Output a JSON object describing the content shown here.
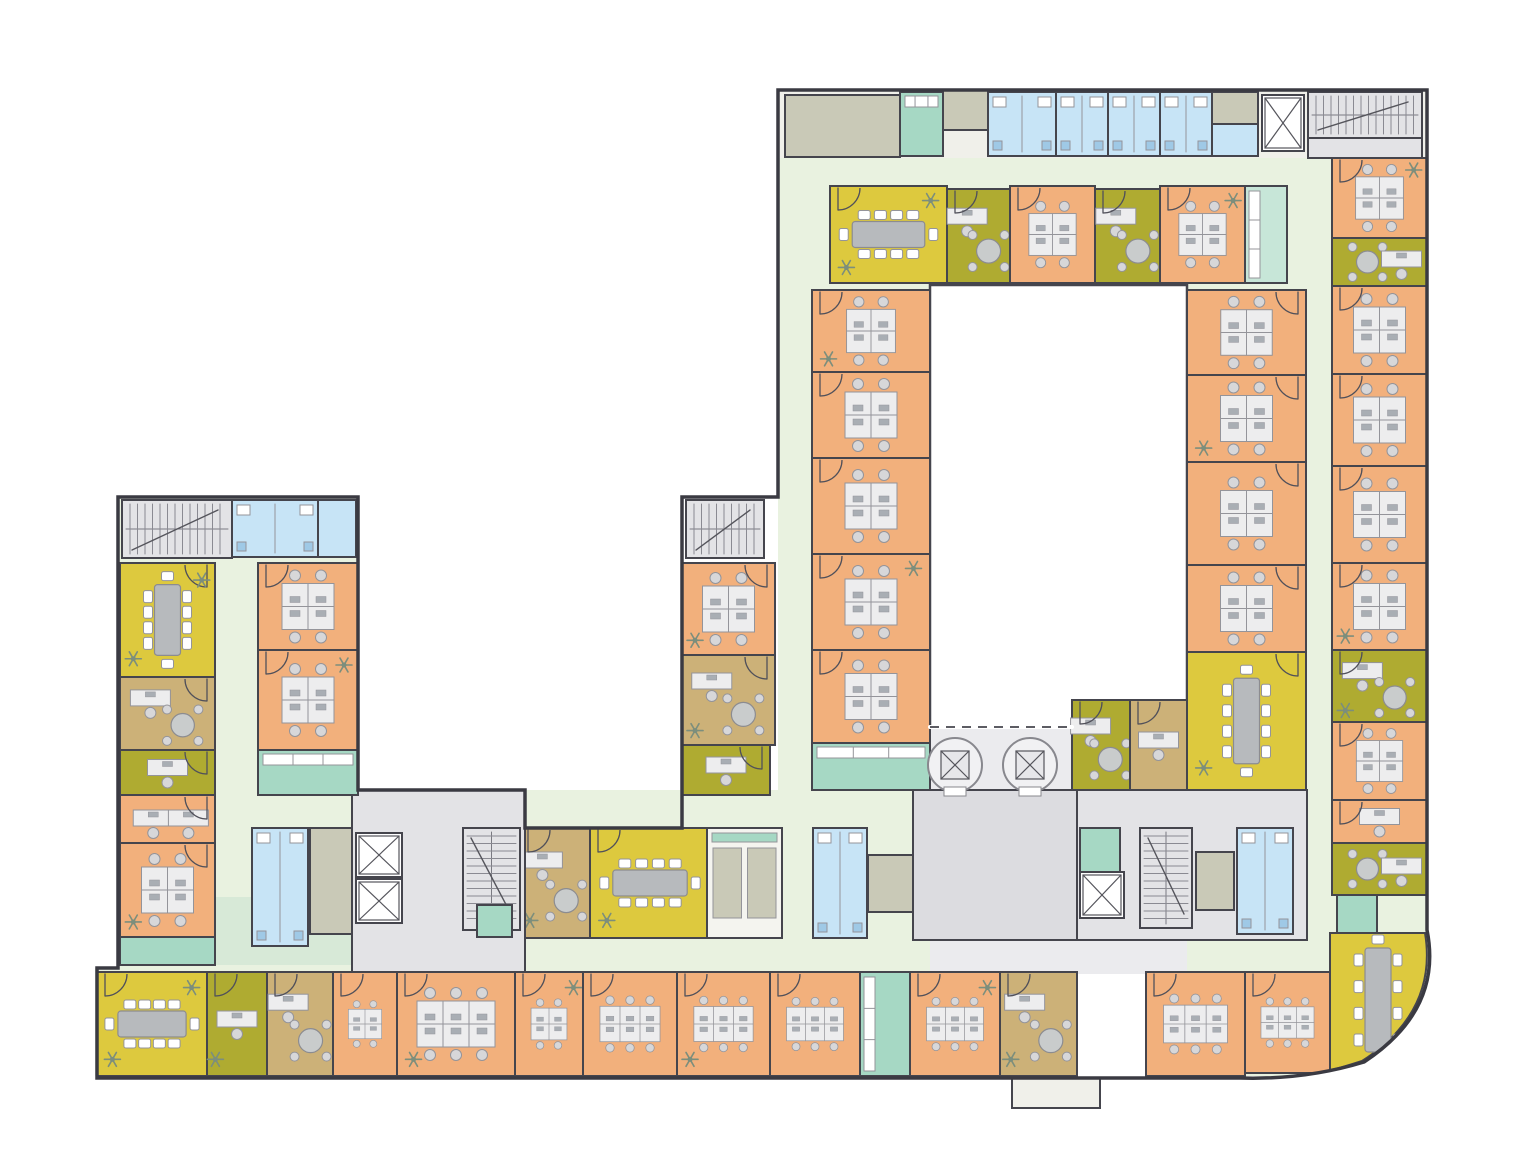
{
  "figure": {
    "kind": "architectural-floor-plan",
    "canvas": {
      "width": 1527,
      "height": 1162
    },
    "legend": {
      "office": "#f2b07c",
      "conference": "#ddc93e",
      "small-office": "#afab31",
      "manager-office": "#ccb178",
      "pantry": "#a6d8c4",
      "wc": "#c7e4f6",
      "core": "#e3e3e6",
      "service": "#c9c9b7",
      "corridor": "#e9f2e0",
      "lobby": "#dcdce0",
      "courtyard": "#ffffff"
    }
  },
  "palette": {
    "wall": "#45454d",
    "office": "#f2b07c",
    "meet": "#ddc93e",
    "olive": "#afab31",
    "tan": "#ccb178",
    "corridor": "#e9f2e0",
    "mint": "#d7e9d7",
    "pantry": "#a6d8c4",
    "pantryLight": "#c7e6d8",
    "wc": "#c7e4f6",
    "core": "#e3e3e6",
    "service": "#c9c9b7",
    "svcwhite": "#f4f4ef",
    "lobby": "#dcdce0",
    "lobbyLight": "#ebebee",
    "white": "#ffffff",
    "panel": "#f0f0ea",
    "deskFill": "#ededee",
    "deskStroke": "#94949a",
    "chair": "#d7d7d9",
    "monitor": "#a9aeb4",
    "table": "#b7babd",
    "plant": "#7c8e7c",
    "door": "#50505a",
    "fixture": "#9fc9e6"
  },
  "outline": {
    "perimeter": "M778,90 H1427 V930 Q1443,1010 1364,1062 Q1305,1080 1240,1078 H97 V968 H118 V497 H358 V790 H525 V828 H682 V497 H778 Z",
    "curveMask": "M1240,1078 Q1305,1080 1364,1062 Q1443,1010 1427,930 L1447,930 L1447,1094 L1240,1094 Z",
    "confSE": "M1330,933 L1425,933 Q1438,1012 1362,1061 Q1334,1070 1330,1070 Z",
    "courtyard": [
      930,
      285,
      257,
      442
    ],
    "dashedEdge": [
      930,
      727,
      1072,
      727
    ]
  },
  "rooms": [
    {
      "id": "backdrop-left-wing",
      "r": [
        118,
        497,
        240,
        471
      ],
      "c": "corridor",
      "ns": 1
    },
    {
      "id": "backdrop-top-strip",
      "r": [
        778,
        90,
        649,
        68
      ],
      "c": "panel",
      "ns": 1
    },
    {
      "id": "backdrop-ring-top",
      "r": [
        778,
        158,
        554,
        127
      ],
      "c": "corridor",
      "ns": 1
    },
    {
      "id": "backdrop-ring-left",
      "r": [
        778,
        285,
        157,
        689
      ],
      "c": "corridor",
      "ns": 1
    },
    {
      "id": "backdrop-ring-right",
      "r": [
        1185,
        285,
        147,
        689
      ],
      "c": "corridor",
      "ns": 1
    },
    {
      "id": "backdrop-right-col",
      "r": [
        1332,
        158,
        95,
        812
      ],
      "c": "corridor",
      "ns": 1
    },
    {
      "id": "backdrop-bottom-wing",
      "r": [
        95,
        828,
        1240,
        248
      ],
      "c": "corridor",
      "ns": 1
    },
    {
      "id": "backdrop-mid-band",
      "r": [
        250,
        790,
        665,
        40
      ],
      "c": "corridor",
      "ns": 1
    },
    {
      "id": "backdrop-terrace",
      "r": [
        930,
        727,
        257,
        247
      ],
      "c": "lobbyLight",
      "ns": 1
    },
    {
      "id": "mint-left-wing",
      "r": [
        120,
        897,
        238,
        68
      ],
      "c": "mint",
      "ns": 1
    },
    {
      "id": "patch-outside-left",
      "r": [
        95,
        828,
        23,
        140
      ],
      "c": "white",
      "ns": 1
    },
    {
      "id": "patch-entry-recess",
      "r": [
        1077,
        974,
        69,
        102
      ],
      "c": "white",
      "ns": 1
    },
    {
      "id": "courtyard",
      "r": [
        930,
        285,
        257,
        442
      ],
      "c": "white"
    },
    {
      "id": "service-room-top",
      "r": [
        785,
        95,
        115,
        62
      ],
      "c": "service"
    },
    {
      "id": "kitchen-top",
      "r": [
        900,
        92,
        43,
        64
      ],
      "c": "pantry",
      "f": "counters"
    },
    {
      "id": "service-box-1",
      "r": [
        943,
        90,
        45,
        40
      ],
      "c": "service"
    },
    {
      "id": "wc-top-1",
      "r": [
        988,
        92,
        68,
        64
      ],
      "c": "wc",
      "f": "wc"
    },
    {
      "id": "wc-top-2",
      "r": [
        1056,
        92,
        52,
        64
      ],
      "c": "wc",
      "f": "wc"
    },
    {
      "id": "wc-top-3",
      "r": [
        1108,
        92,
        52,
        64
      ],
      "c": "wc",
      "f": "wc"
    },
    {
      "id": "wc-top-4",
      "r": [
        1160,
        92,
        52,
        64
      ],
      "c": "wc",
      "f": "wc"
    },
    {
      "id": "service-box-2",
      "r": [
        1212,
        92,
        46,
        32
      ],
      "c": "service"
    },
    {
      "id": "wc-top-5",
      "r": [
        1212,
        124,
        46,
        32
      ],
      "c": "wc"
    },
    {
      "id": "elevator-top",
      "r": [
        1262,
        95,
        42,
        56
      ],
      "c": "white",
      "f": "elev"
    },
    {
      "id": "stair-top-right",
      "r": [
        1308,
        92,
        114,
        46
      ],
      "c": "core",
      "f": "stairsH"
    },
    {
      "id": "landing-top-right",
      "r": [
        1308,
        138,
        114,
        20
      ],
      "c": "core"
    },
    {
      "id": "conf-room-ne",
      "r": [
        830,
        186,
        117,
        97
      ],
      "c": "meet",
      "f": "confH",
      "p": 3
    },
    {
      "id": "olive-office-ne1",
      "r": [
        947,
        189,
        63,
        94
      ],
      "c": "olive",
      "f": "deskRT"
    },
    {
      "id": "office-ne1",
      "r": [
        1010,
        186,
        85,
        97
      ],
      "c": "office",
      "f": "cluster4"
    },
    {
      "id": "olive-office-ne2",
      "r": [
        1095,
        189,
        65,
        94
      ],
      "c": "olive",
      "f": "deskRT"
    },
    {
      "id": "office-ne2",
      "r": [
        1160,
        186,
        85,
        97
      ],
      "c": "office",
      "f": "cluster4",
      "p": 2
    },
    {
      "id": "pantry-ne",
      "r": [
        1245,
        186,
        42,
        97
      ],
      "c": "pantryLight",
      "f": "countersV"
    },
    {
      "id": "office-w1",
      "r": [
        812,
        290,
        118,
        82
      ],
      "c": "office",
      "f": "cluster4",
      "p": 1
    },
    {
      "id": "office-w2",
      "r": [
        812,
        372,
        118,
        86
      ],
      "c": "office",
      "f": "cluster4"
    },
    {
      "id": "office-w3",
      "r": [
        812,
        458,
        118,
        96
      ],
      "c": "office",
      "f": "cluster4"
    },
    {
      "id": "office-w4",
      "r": [
        812,
        554,
        118,
        96
      ],
      "c": "office",
      "f": "cluster4",
      "p": 2
    },
    {
      "id": "office-w5",
      "r": [
        812,
        650,
        118,
        93
      ],
      "c": "office",
      "f": "cluster4"
    },
    {
      "id": "pantry-w",
      "r": [
        812,
        743,
        118,
        47
      ],
      "c": "pantry",
      "f": "counters"
    },
    {
      "id": "office-e1",
      "r": [
        1187,
        290,
        119,
        85
      ],
      "c": "office",
      "f": "cluster4"
    },
    {
      "id": "office-e2",
      "r": [
        1187,
        375,
        119,
        87
      ],
      "c": "office",
      "f": "cluster4",
      "p": 1
    },
    {
      "id": "office-e3",
      "r": [
        1187,
        462,
        119,
        103
      ],
      "c": "office",
      "f": "cluster4"
    },
    {
      "id": "office-e4",
      "r": [
        1187,
        565,
        119,
        87
      ],
      "c": "office",
      "f": "cluster4"
    },
    {
      "id": "conf-room-e",
      "r": [
        1187,
        652,
        119,
        138
      ],
      "c": "meet",
      "f": "confV",
      "p": 1
    },
    {
      "id": "olive-office-ct",
      "r": [
        1072,
        700,
        58,
        90
      ],
      "c": "olive",
      "f": "deskRT"
    },
    {
      "id": "tan-office-ct",
      "r": [
        1130,
        700,
        57,
        90
      ],
      "c": "tan",
      "f": "desk"
    },
    {
      "id": "office-r1",
      "r": [
        1332,
        158,
        95,
        80
      ],
      "c": "office",
      "f": "cluster4",
      "p": 2
    },
    {
      "id": "olive-office-r0",
      "r": [
        1332,
        238,
        95,
        48
      ],
      "c": "olive",
      "f": "roundT"
    },
    {
      "id": "office-r2",
      "r": [
        1332,
        286,
        95,
        88
      ],
      "c": "office",
      "f": "cluster4"
    },
    {
      "id": "office-r3",
      "r": [
        1332,
        374,
        95,
        92
      ],
      "c": "office",
      "f": "cluster4"
    },
    {
      "id": "office-r4",
      "r": [
        1332,
        466,
        95,
        97
      ],
      "c": "office",
      "f": "cluster4"
    },
    {
      "id": "office-r5",
      "r": [
        1332,
        563,
        95,
        87
      ],
      "c": "office",
      "f": "cluster4",
      "p": 1
    },
    {
      "id": "olive-office-r1",
      "r": [
        1332,
        650,
        95,
        72
      ],
      "c": "olive",
      "f": "deskRT",
      "p": 1
    },
    {
      "id": "office-r6",
      "r": [
        1332,
        722,
        95,
        78
      ],
      "c": "office",
      "f": "cluster4"
    },
    {
      "id": "office-r7",
      "r": [
        1332,
        800,
        95,
        43
      ],
      "c": "office",
      "f": "desk"
    },
    {
      "id": "olive-office-r2",
      "r": [
        1332,
        843,
        95,
        52
      ],
      "c": "olive",
      "f": "roundT"
    },
    {
      "id": "pantry-r",
      "r": [
        1337,
        895,
        40,
        38
      ],
      "c": "pantry"
    },
    {
      "id": "conf-room-se",
      "shape": "confSE",
      "c": "meet",
      "f": "confV2",
      "p": 1
    },
    {
      "id": "core-r",
      "r": [
        1077,
        790,
        230,
        150
      ],
      "c": "core"
    },
    {
      "id": "pantry-core-r",
      "r": [
        1080,
        828,
        40,
        44
      ],
      "c": "pantry"
    },
    {
      "id": "elevator-r",
      "r": [
        1080,
        872,
        44,
        46
      ],
      "c": "white",
      "f": "elev"
    },
    {
      "id": "stair-r",
      "r": [
        1140,
        828,
        52,
        100
      ],
      "c": "core",
      "f": "stairsV"
    },
    {
      "id": "service-core-r",
      "r": [
        1196,
        852,
        38,
        58
      ],
      "c": "service"
    },
    {
      "id": "wc-core-r",
      "r": [
        1237,
        828,
        56,
        106
      ],
      "c": "wc",
      "f": "wc"
    },
    {
      "id": "tan-office-mid",
      "r": [
        520,
        828,
        70,
        110
      ],
      "c": "tan",
      "f": "deskRT",
      "p": 1
    },
    {
      "id": "conf-room-mid",
      "r": [
        590,
        828,
        120,
        110
      ],
      "c": "meet",
      "f": "confH",
      "p": 1
    },
    {
      "id": "service-mid",
      "r": [
        707,
        828,
        75,
        110
      ],
      "c": "svcwhite",
      "f": "svcbox2"
    },
    {
      "id": "wc-mid",
      "r": [
        813,
        828,
        54,
        110
      ],
      "c": "wc",
      "f": "wc"
    },
    {
      "id": "service-mid-2",
      "r": [
        868,
        855,
        45,
        57
      ],
      "c": "service"
    },
    {
      "id": "lobby",
      "r": [
        913,
        790,
        164,
        150
      ],
      "c": "lobby"
    },
    {
      "id": "core-c",
      "r": [
        352,
        790,
        173,
        183
      ],
      "c": "core"
    },
    {
      "id": "wc-c",
      "r": [
        252,
        828,
        56,
        118
      ],
      "c": "wc",
      "f": "wc"
    },
    {
      "id": "service-c",
      "r": [
        310,
        828,
        42,
        106
      ],
      "c": "service"
    },
    {
      "id": "elevator-c1",
      "r": [
        356,
        833,
        46,
        44
      ],
      "c": "white",
      "f": "elev"
    },
    {
      "id": "elevator-c2",
      "r": [
        356,
        879,
        46,
        44
      ],
      "c": "white",
      "f": "elev"
    },
    {
      "id": "stair-c",
      "r": [
        463,
        828,
        57,
        102
      ],
      "c": "core",
      "f": "stairsV"
    },
    {
      "id": "pantry-core-c",
      "r": [
        477,
        905,
        35,
        32
      ],
      "c": "pantry"
    },
    {
      "id": "stair-lw",
      "r": [
        122,
        500,
        110,
        58
      ],
      "c": "core",
      "f": "stairsH"
    },
    {
      "id": "wc-lw",
      "r": [
        232,
        500,
        86,
        57
      ],
      "c": "wc",
      "f": "wc"
    },
    {
      "id": "wc-lw2",
      "r": [
        318,
        500,
        38,
        57
      ],
      "c": "wc"
    },
    {
      "id": "conf-room-w",
      "r": [
        120,
        563,
        95,
        114
      ],
      "c": "meet",
      "f": "confV",
      "p": 3
    },
    {
      "id": "tan-office-w",
      "r": [
        120,
        677,
        95,
        73
      ],
      "c": "tan",
      "f": "deskRT"
    },
    {
      "id": "olive-office-w",
      "r": [
        120,
        750,
        95,
        45
      ],
      "c": "olive",
      "f": "desk"
    },
    {
      "id": "office-lw1",
      "r": [
        120,
        795,
        95,
        48
      ],
      "c": "office",
      "f": "desk2"
    },
    {
      "id": "office-lw2",
      "r": [
        120,
        843,
        95,
        94
      ],
      "c": "office",
      "f": "cluster4",
      "p": 1
    },
    {
      "id": "pantry-lw",
      "r": [
        120,
        937,
        95,
        28
      ],
      "c": "pantry"
    },
    {
      "id": "office-lwi1",
      "r": [
        258,
        563,
        100,
        87
      ],
      "c": "office",
      "f": "cluster4"
    },
    {
      "id": "office-lwi2",
      "r": [
        258,
        650,
        100,
        100
      ],
      "c": "office",
      "f": "cluster4",
      "p": 2
    },
    {
      "id": "pantry-lwi",
      "r": [
        258,
        750,
        100,
        45
      ],
      "c": "pantry",
      "f": "counters"
    },
    {
      "id": "stair-ms",
      "r": [
        686,
        500,
        78,
        58
      ],
      "c": "core",
      "f": "stairsH"
    },
    {
      "id": "office-ms",
      "r": [
        682,
        563,
        93,
        92
      ],
      "c": "office",
      "f": "cluster4",
      "p": 1
    },
    {
      "id": "tan-office-ms",
      "r": [
        682,
        655,
        93,
        90
      ],
      "c": "tan",
      "f": "deskRT",
      "p": 1
    },
    {
      "id": "olive-office-ms",
      "r": [
        682,
        745,
        88,
        50
      ],
      "c": "olive",
      "f": "desk"
    },
    {
      "id": "conf-room-sw",
      "r": [
        97,
        972,
        110,
        104
      ],
      "c": "meet",
      "f": "confH",
      "p": 3
    },
    {
      "id": "olive-office-sw",
      "r": [
        207,
        972,
        60,
        104
      ],
      "c": "olive",
      "f": "desk",
      "p": 1
    },
    {
      "id": "tan-office-sw",
      "r": [
        267,
        972,
        66,
        104
      ],
      "c": "tan",
      "f": "deskRT"
    },
    {
      "id": "office-b1",
      "r": [
        333,
        972,
        64,
        104
      ],
      "c": "office",
      "f": "cluster4"
    },
    {
      "id": "office-b2",
      "r": [
        397,
        972,
        118,
        104
      ],
      "c": "office",
      "f": "cluster6",
      "p": 1
    },
    {
      "id": "office-b3",
      "r": [
        515,
        972,
        68,
        104
      ],
      "c": "office",
      "f": "cluster4",
      "p": 2
    },
    {
      "id": "office-b4",
      "r": [
        583,
        972,
        94,
        104
      ],
      "c": "office",
      "f": "cluster6"
    },
    {
      "id": "office-b5",
      "r": [
        677,
        972,
        93,
        104
      ],
      "c": "office",
      "f": "cluster6",
      "p": 1
    },
    {
      "id": "office-b6",
      "r": [
        770,
        972,
        90,
        104
      ],
      "c": "office",
      "f": "cluster6"
    },
    {
      "id": "pantry-b",
      "r": [
        860,
        972,
        50,
        104
      ],
      "c": "pantry",
      "f": "countersV"
    },
    {
      "id": "office-b7",
      "r": [
        910,
        972,
        90,
        104
      ],
      "c": "office",
      "f": "cluster6",
      "p": 2
    },
    {
      "id": "tan-office-b",
      "r": [
        1000,
        972,
        77,
        104
      ],
      "c": "tan",
      "f": "deskRT",
      "p": 1
    },
    {
      "id": "office-b8",
      "r": [
        1146,
        972,
        99,
        104
      ],
      "c": "office",
      "f": "cluster6"
    },
    {
      "id": "office-b9",
      "r": [
        1245,
        972,
        85,
        101
      ],
      "c": "office",
      "f": "cluster6"
    },
    {
      "id": "entrance-porch",
      "r": [
        1012,
        1078,
        88,
        30
      ],
      "c": "panel"
    },
    {
      "id": "spiral-stair-1",
      "circle": [
        955,
        765,
        27
      ]
    },
    {
      "id": "spiral-stair-2",
      "circle": [
        1030,
        765,
        27
      ]
    }
  ],
  "doorsTopRight": [
    "office-e1",
    "office-e2",
    "office-e3",
    "office-e4",
    "conf-room-e",
    "conf-room-w",
    "tan-office-w",
    "olive-office-w",
    "office-lw1",
    "office-lw2",
    "office-ms",
    "tan-office-ms",
    "olive-office-ms"
  ]
}
